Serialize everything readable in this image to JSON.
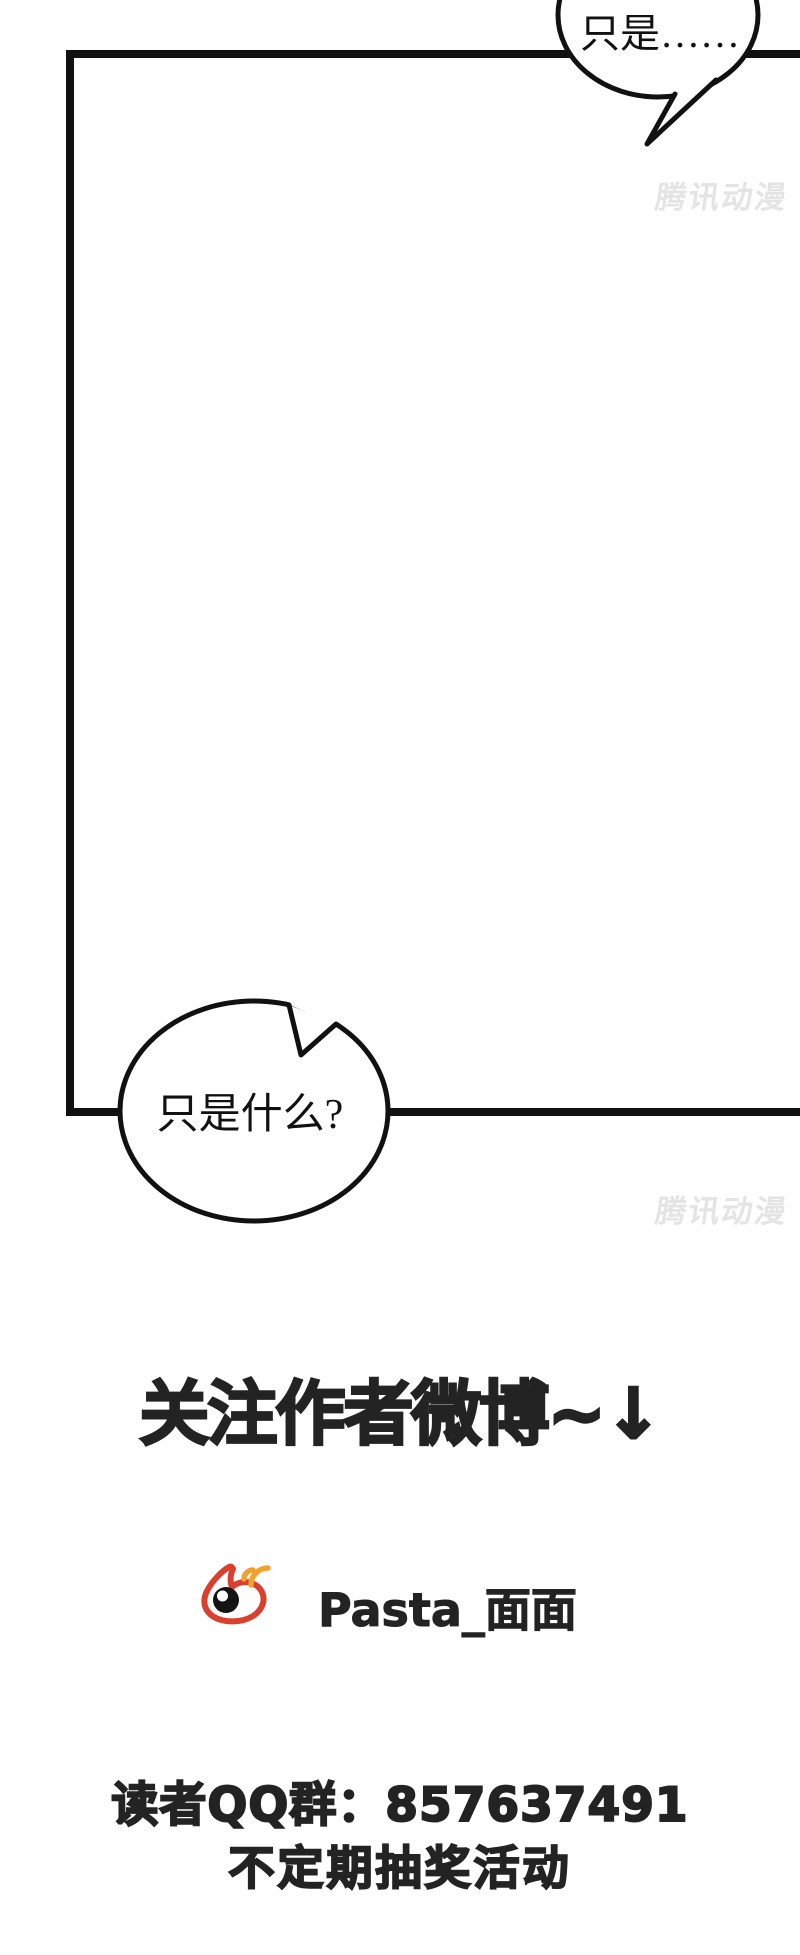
{
  "comic": {
    "panel_border_color": "#111111",
    "ink_color": "#232323",
    "bubble_top": {
      "text": "只是……"
    },
    "bubble_bottom": {
      "text": "只是什么?"
    },
    "watermark": {
      "text": "腾讯动漫",
      "color": "#e4e4e4"
    },
    "footer": {
      "heading": "关注作者微博~↓",
      "weibo_handle": "Pasta_面面",
      "qq_line1": "读者QQ群：857637491",
      "qq_line2": "不定期抽奖活动"
    },
    "weibo_icon": {
      "body_color": "#d9402f",
      "wave_color": "#f0a330",
      "pupil_color": "#141414"
    }
  }
}
